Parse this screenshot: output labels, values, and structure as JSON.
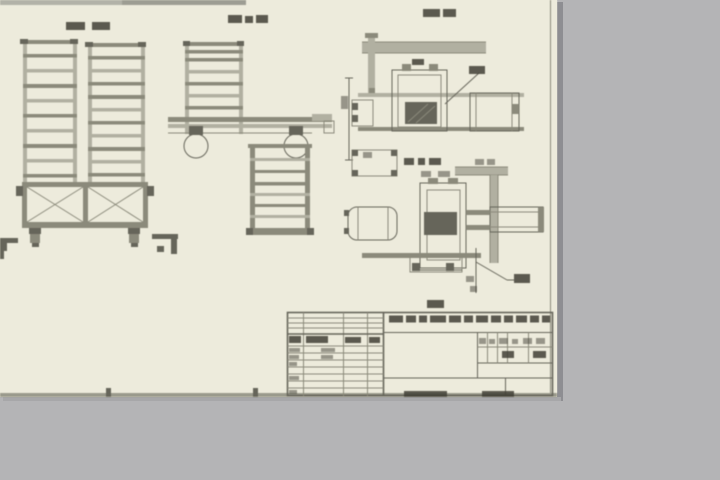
{
  "window": {
    "background": "#b4b4b6"
  },
  "colors": {
    "bg": "#b4b4b6",
    "sheet": "#edebdc",
    "light": "#b1b0a1",
    "line": "#8b8a7b",
    "dark": "#66655a",
    "ink": "#413f36",
    "shadow": "#8e8e92",
    "edge": "#9a9a8c",
    "band1": "#b2b2a8",
    "band2": "#9d9d93"
  },
  "sheet": {
    "width_px": 557,
    "height_px": 397,
    "type": "engineering-drawing-scan",
    "all_text_illegible": true
  },
  "drawing": {
    "views": [
      {
        "id": "front-view",
        "content": "two ladder racks on cross-braced wheeled base",
        "label_text": ""
      },
      {
        "id": "side-view",
        "content": "side view with two casters and flat ladder panel",
        "label_text": ""
      },
      {
        "id": "detail-a",
        "content": "enlarged clamp detail with dimension lines",
        "label_text": ""
      },
      {
        "id": "detail-b",
        "content": "enlarged axle detail with leader callouts",
        "label_text": ""
      }
    ],
    "title_block": {
      "style": "GOST grid title block",
      "text": ""
    }
  }
}
